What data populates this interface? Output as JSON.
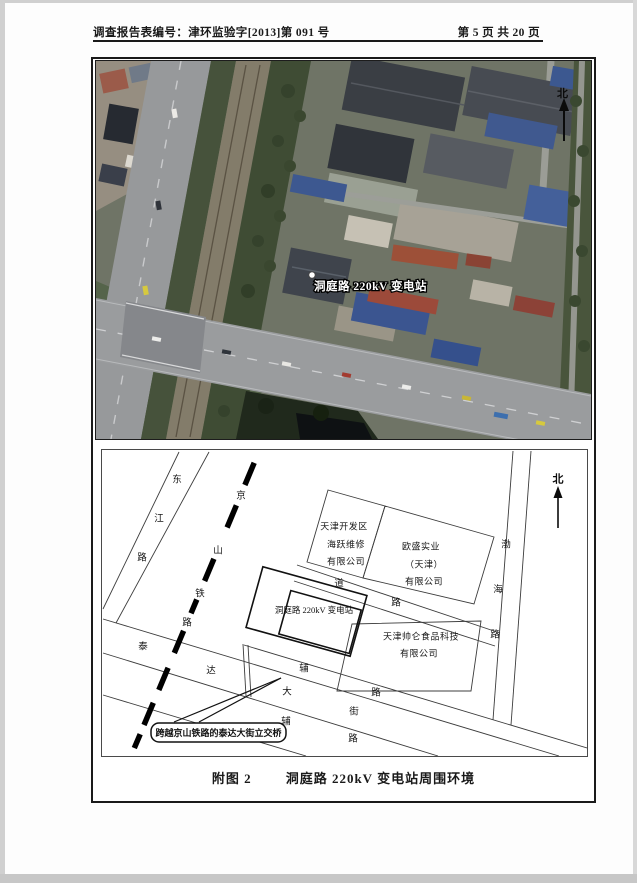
{
  "header": {
    "report_no_label": "调查报告表编号：津环监验字[2013]第 091 号",
    "page_info": "第 5 页 共 20 页"
  },
  "satellite": {
    "station_label": "洞庭路 220kV 变电站",
    "north_label": "北"
  },
  "map": {
    "north_label": "北",
    "roads": {
      "dongjiang": [
        "东",
        "江",
        "路"
      ],
      "jingshan_railway": [
        "京",
        "山",
        "铁",
        "路"
      ],
      "teda_street": [
        "泰",
        "达",
        "大",
        "街"
      ],
      "north_service": [
        "辅",
        "路"
      ],
      "south_service": [
        "辅",
        "路"
      ],
      "bohai": [
        "渤",
        "海",
        "路"
      ],
      "inner_road": [
        "道",
        "路"
      ]
    },
    "buildings": {
      "haiyue": [
        "天津开发区",
        "海跃维修",
        "有限公司"
      ],
      "ousheng": [
        "欧盛实业",
        "（天津）",
        "有限公司"
      ],
      "shuailun": [
        "天津帅仑食品科技",
        "有限公司"
      ],
      "substation_label": "洞庭路 220kV 变电站"
    },
    "callout": "跨越京山铁路的泰达大街立交桥"
  },
  "caption": {
    "fig_no": "附图 2",
    "title": "洞庭路 220kV 变电站周围环境"
  },
  "palette": {
    "frame": "#1a1a1a",
    "map_line": "#3c3c3c",
    "road_gray": "#9a9c9e",
    "roof_blue": "#3b5590",
    "roof_red": "#9c4a3a",
    "vegetation": "#46523b"
  }
}
